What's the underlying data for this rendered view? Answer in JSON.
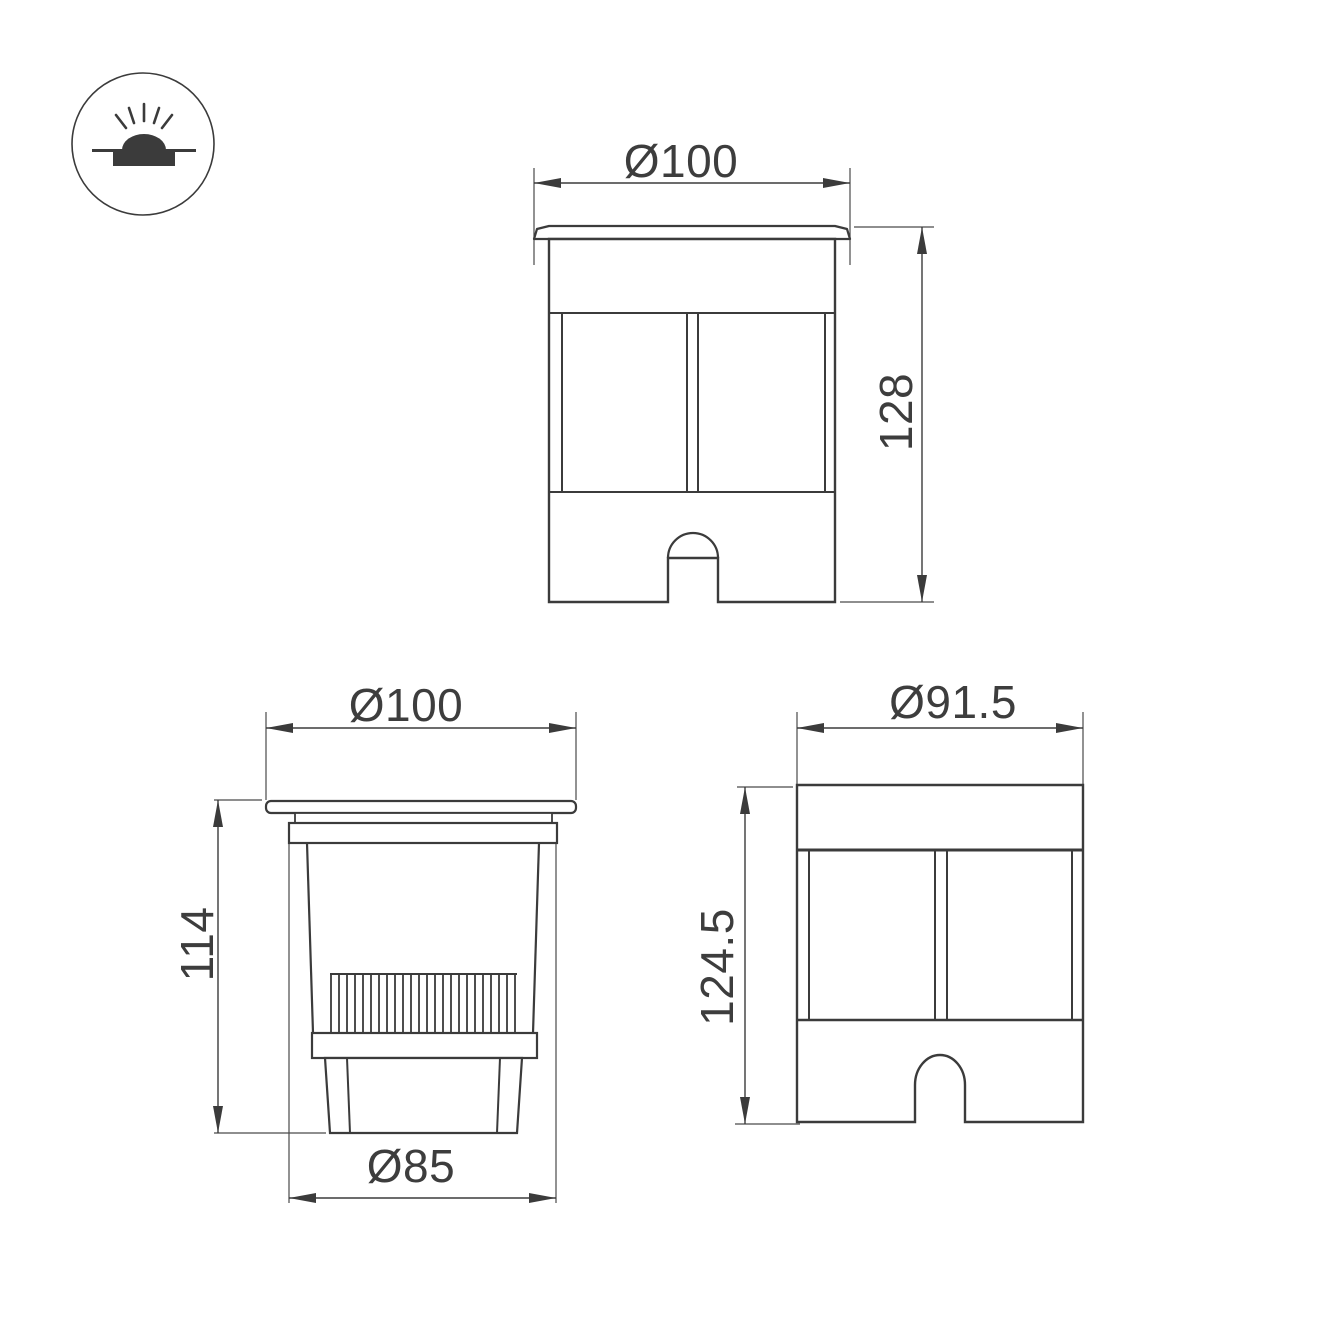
{
  "page": {
    "background_color": "#ffffff",
    "line_color": "#3b3b3b",
    "dimension_text_color": "#3d3d3d"
  },
  "icon": {
    "meaning": "recessed-ground-light-icon"
  },
  "views": {
    "front": {
      "diameter_label": "Ø100",
      "height_label": "128"
    },
    "section": {
      "diameter_label": "Ø100",
      "height_label": "114",
      "base_diameter_label": "Ø85"
    },
    "rear": {
      "diameter_label": "Ø91.5",
      "height_label": "124.5"
    }
  }
}
